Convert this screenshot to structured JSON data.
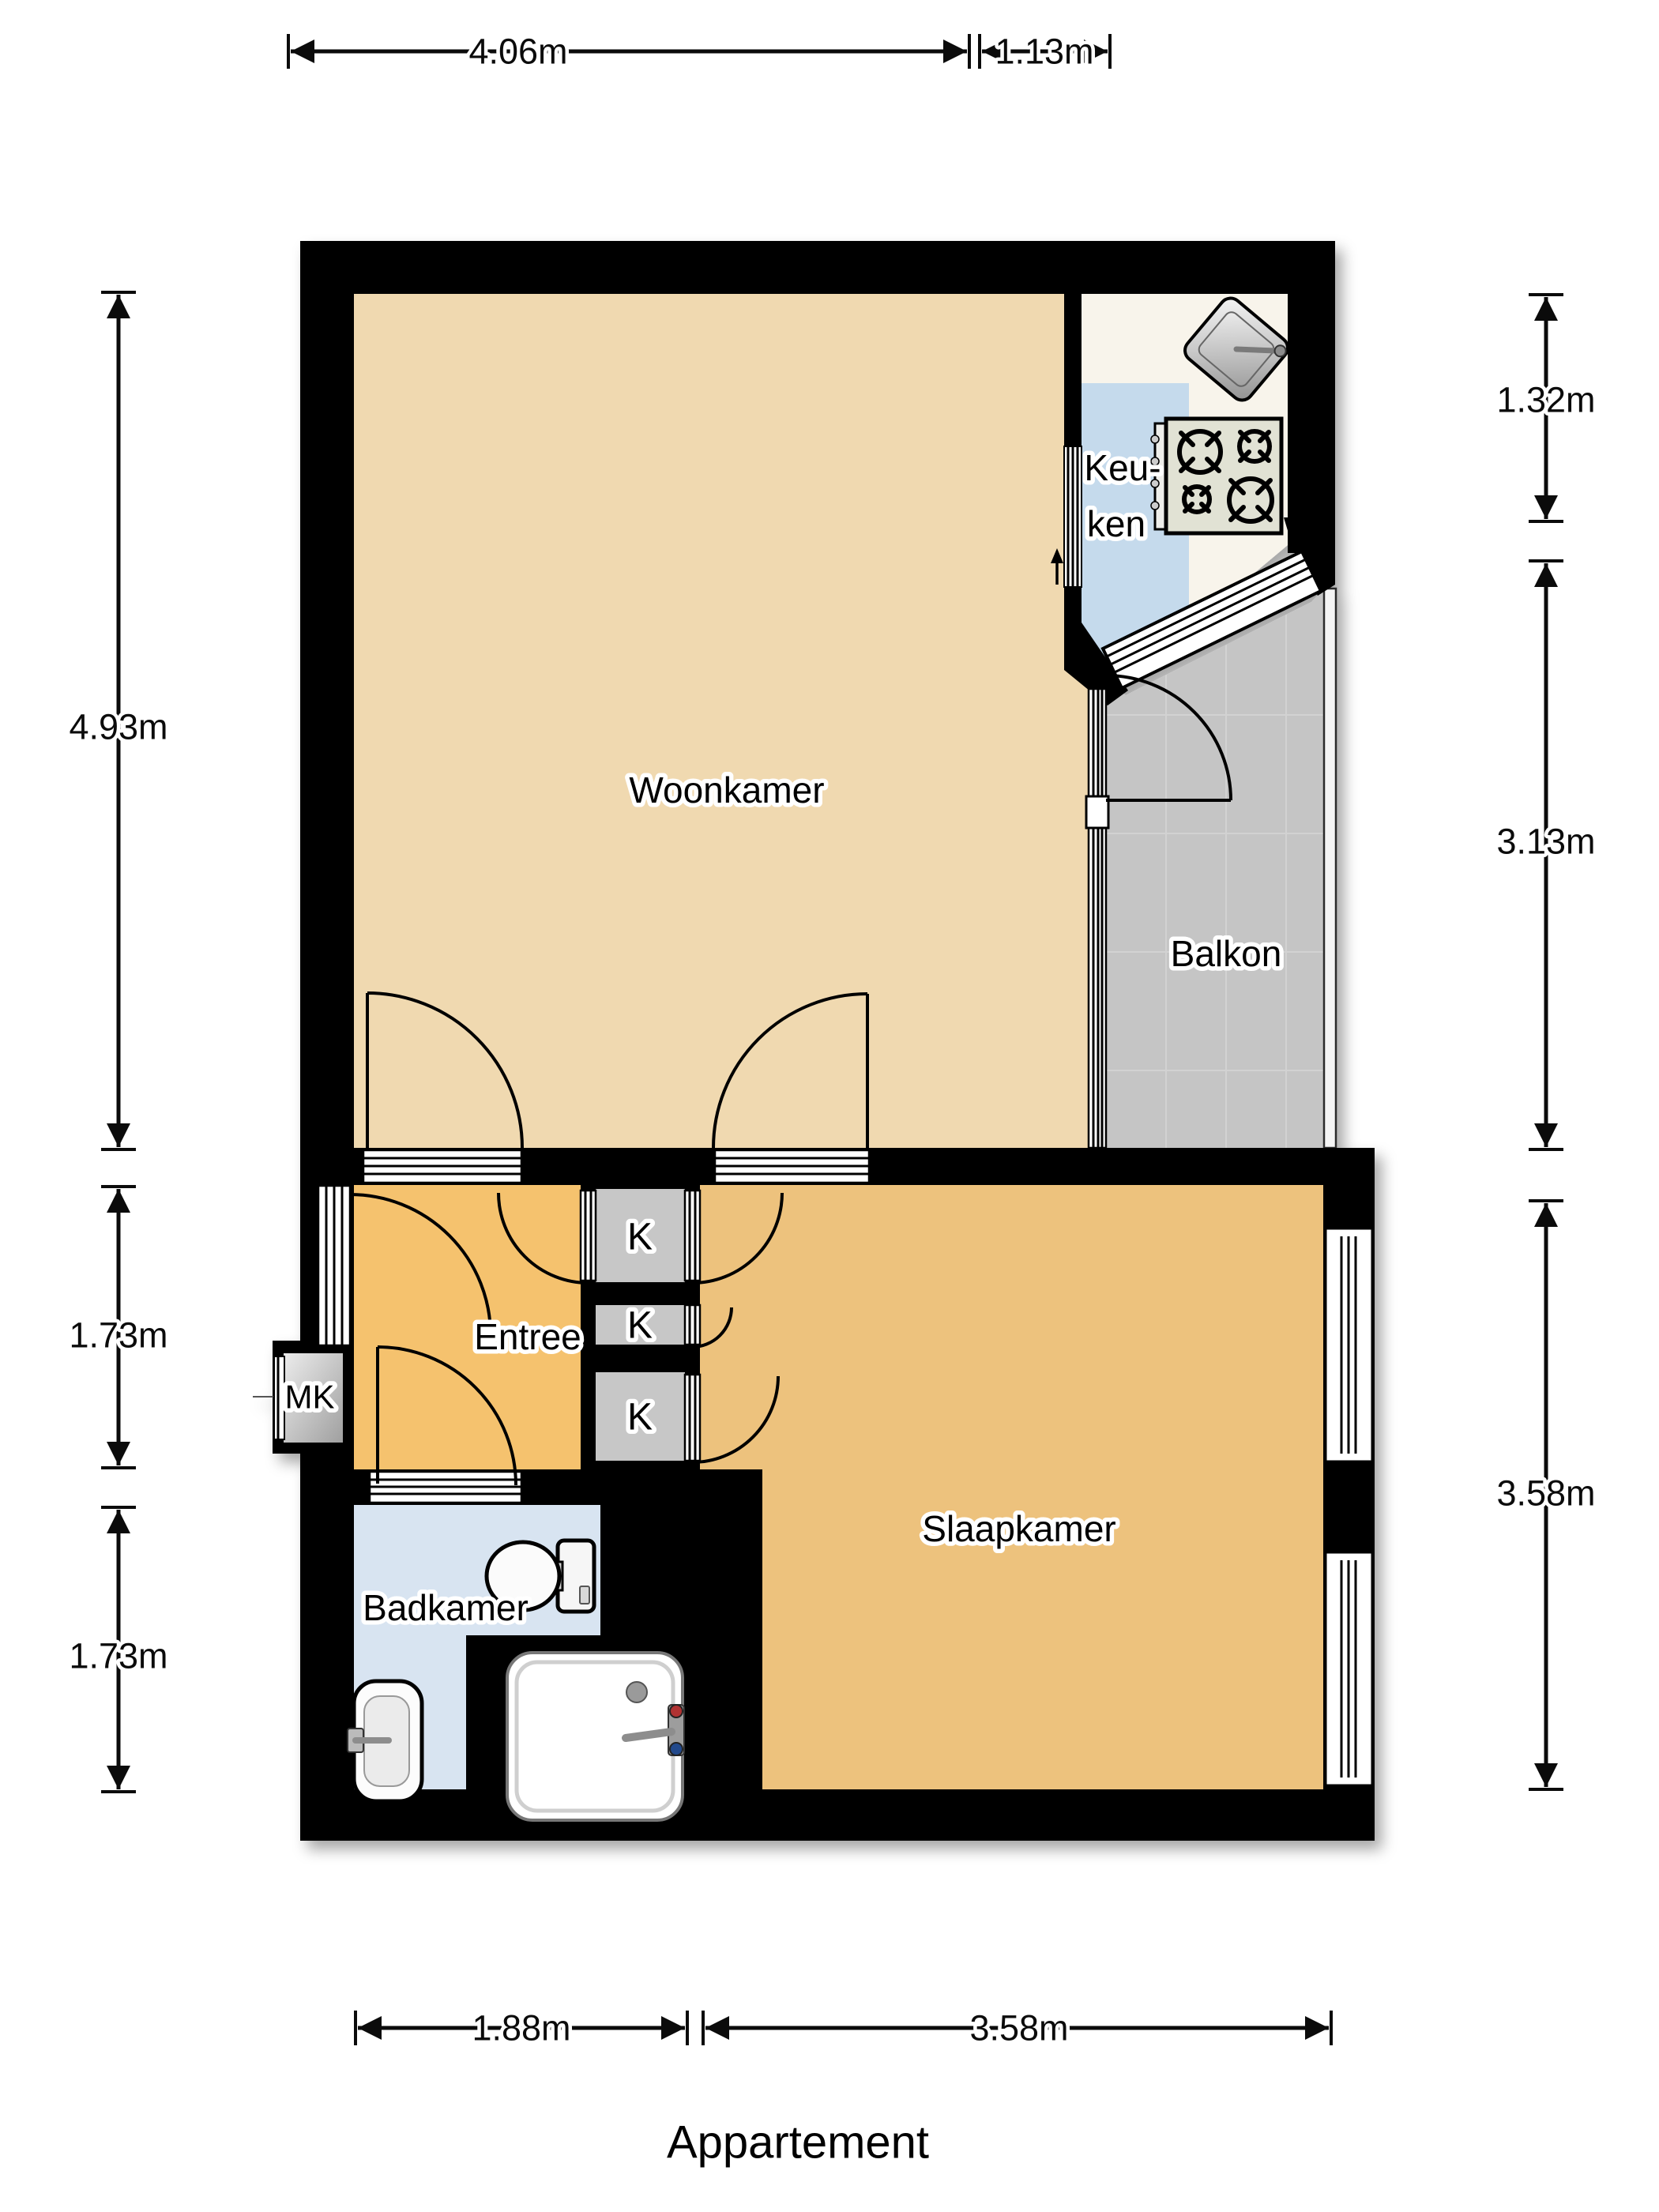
{
  "title": "Appartement",
  "rooms": {
    "woonkamer": "Woonkamer",
    "keuken_line1": "Keu-",
    "keuken_line2": "ken",
    "balkon": "Balkon",
    "entree": "Entree",
    "slaapkamer": "Slaapkamer",
    "badkamer": "Badkamer",
    "meter_closet": "MK",
    "closet": "K"
  },
  "dims": {
    "top_a": "4.06m",
    "top_b": "1.13m",
    "left_a": "4.93m",
    "left_b": "1.73m",
    "left_c": "1.73m",
    "right_a": "1.32m",
    "right_b": "3.13m",
    "right_c": "3.58m",
    "bottom_a": "1.88m",
    "bottom_b": "3.58m"
  },
  "colors": {
    "wall": "#000000",
    "woonkamer_floor": "#F0D9B0",
    "entree_floor": "#F5C26E",
    "slaapkamer_floor": "#EDC27D",
    "badkamer_floor": "#D8E4F1",
    "keuken_floor": "#F8F4EB",
    "counter": "#C5DAEC",
    "balkon_floor": "#C5C5C5",
    "closet_floor": "#C7C7C7",
    "stove": "#E1E2D4"
  }
}
